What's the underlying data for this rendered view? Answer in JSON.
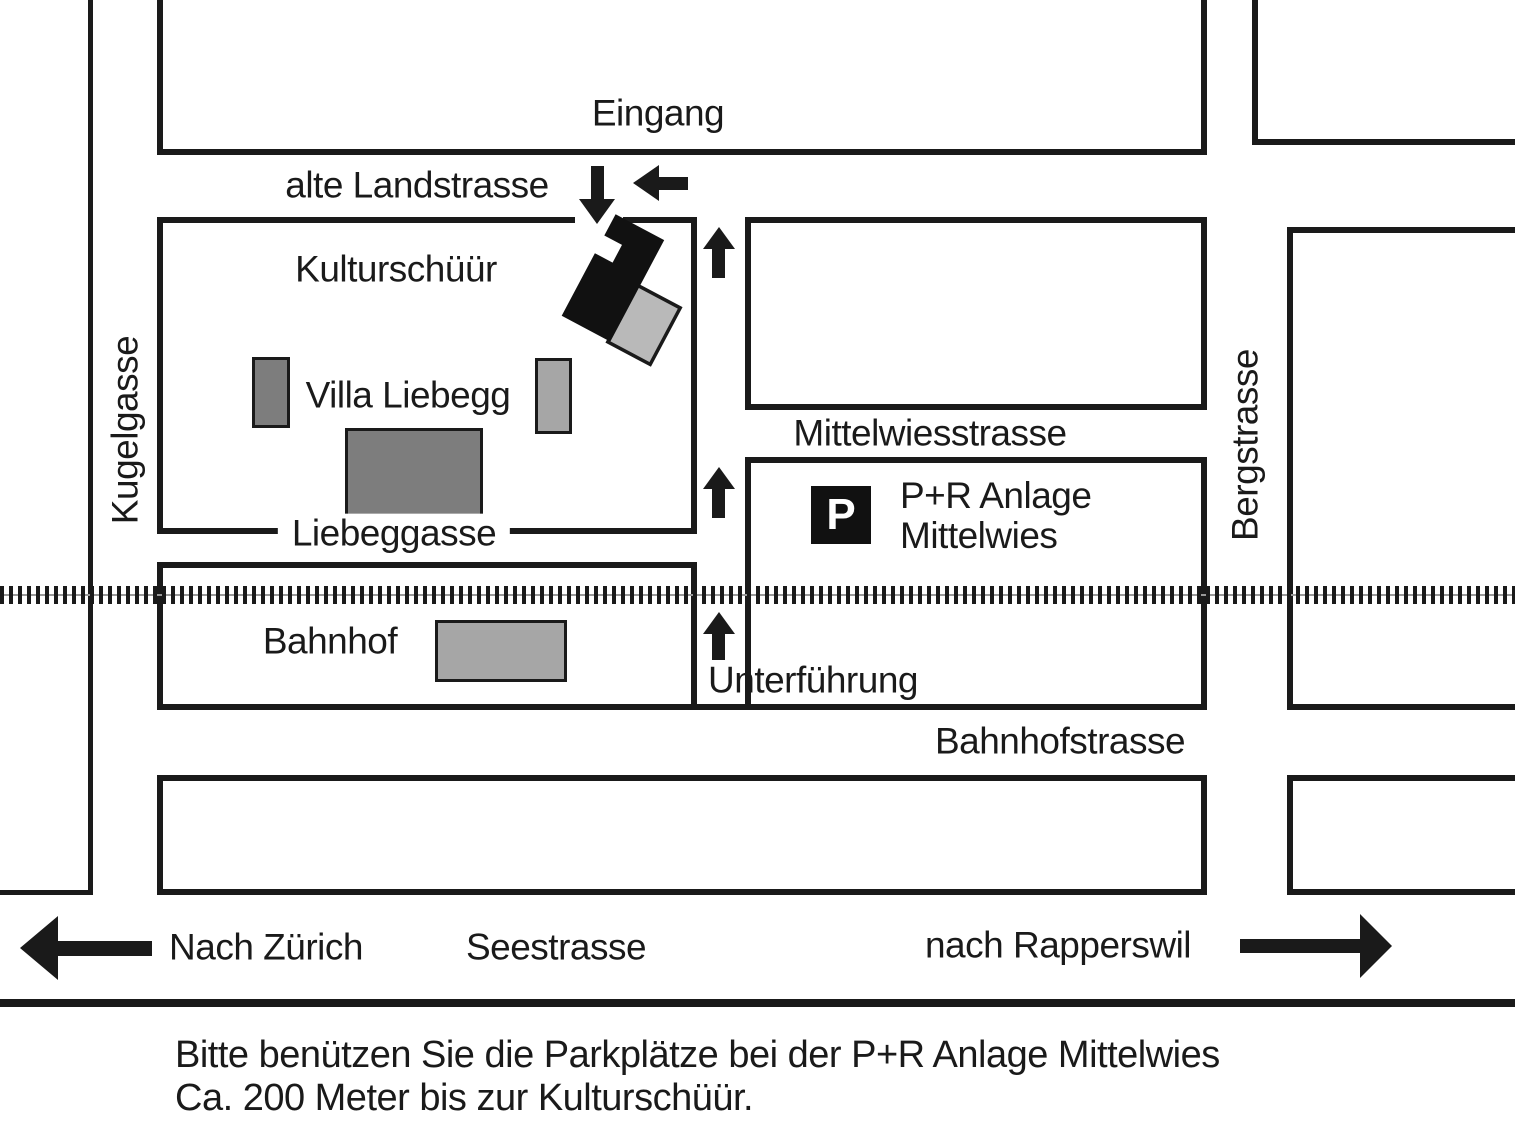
{
  "labels": {
    "eingang": "Eingang",
    "alte_landstrasse": "alte Landstrasse",
    "kulturschuur": "Kulturschüür",
    "villa_liebegg": "Villa Liebegg",
    "liebeggasse": "Liebeggasse",
    "kugelgasse": "Kugelgasse",
    "mittelwiesstrasse": "Mittelwiesstrasse",
    "bergstrasse": "Bergstrasse",
    "bahnhof": "Bahnhof",
    "unterfuehrung": "Unterführung",
    "bahnhofstrasse": "Bahnhofstrasse",
    "nach_zuerich": "Nach Zürich",
    "seestrasse": "Seestrasse",
    "nach_rapperswil": "nach Rapperswil"
  },
  "parking": {
    "icon_letter": "P",
    "line1": "P+R Anlage",
    "line2": "Mittelwies"
  },
  "caption": {
    "line1": "Bitte benützen Sie die Parkplätze bei der P+R Anlage Mittelwies",
    "line2": "Ca. 200 Meter bis zur Kulturschüür."
  },
  "colors": {
    "ink": "#1a1a1a",
    "building_black": "#111111",
    "building_dark_gray": "#7d7d7d",
    "building_medium_gray": "#a6a6a6",
    "building_light_gray": "#b9b9b9",
    "railway_center_line": "#999999",
    "background": "#ffffff"
  }
}
